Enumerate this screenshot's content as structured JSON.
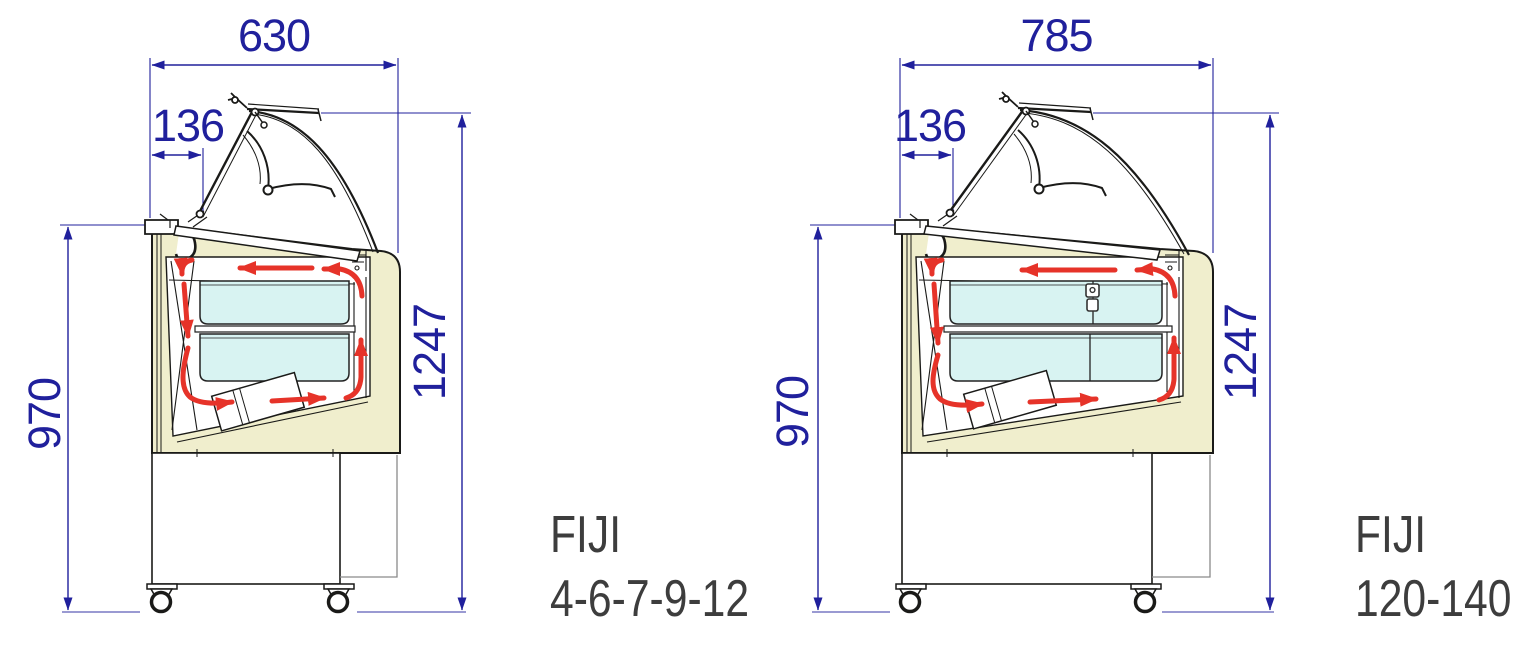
{
  "colors": {
    "dimension_blue": "#20209c",
    "airflow_red": "#e63329",
    "body_cream": "#f0eecd",
    "tub_blue": "#d8f3f2",
    "outline_dark": "#1a1a18",
    "extension_gray": "#8a8a8a",
    "ground_line": "#9a9ad2",
    "model_text": "#3d3d3d"
  },
  "diagrams": [
    {
      "name": "FIJI",
      "range": "4-6-7-9-12",
      "dims": {
        "overall_width": "630",
        "lid_overhang": "136",
        "body_height": "970",
        "overall_height": "1247"
      }
    },
    {
      "name": "FIJI",
      "range": "120-140",
      "dims": {
        "overall_width": "785",
        "lid_overhang": "136",
        "body_height": "970",
        "overall_height": "1247"
      }
    }
  ]
}
